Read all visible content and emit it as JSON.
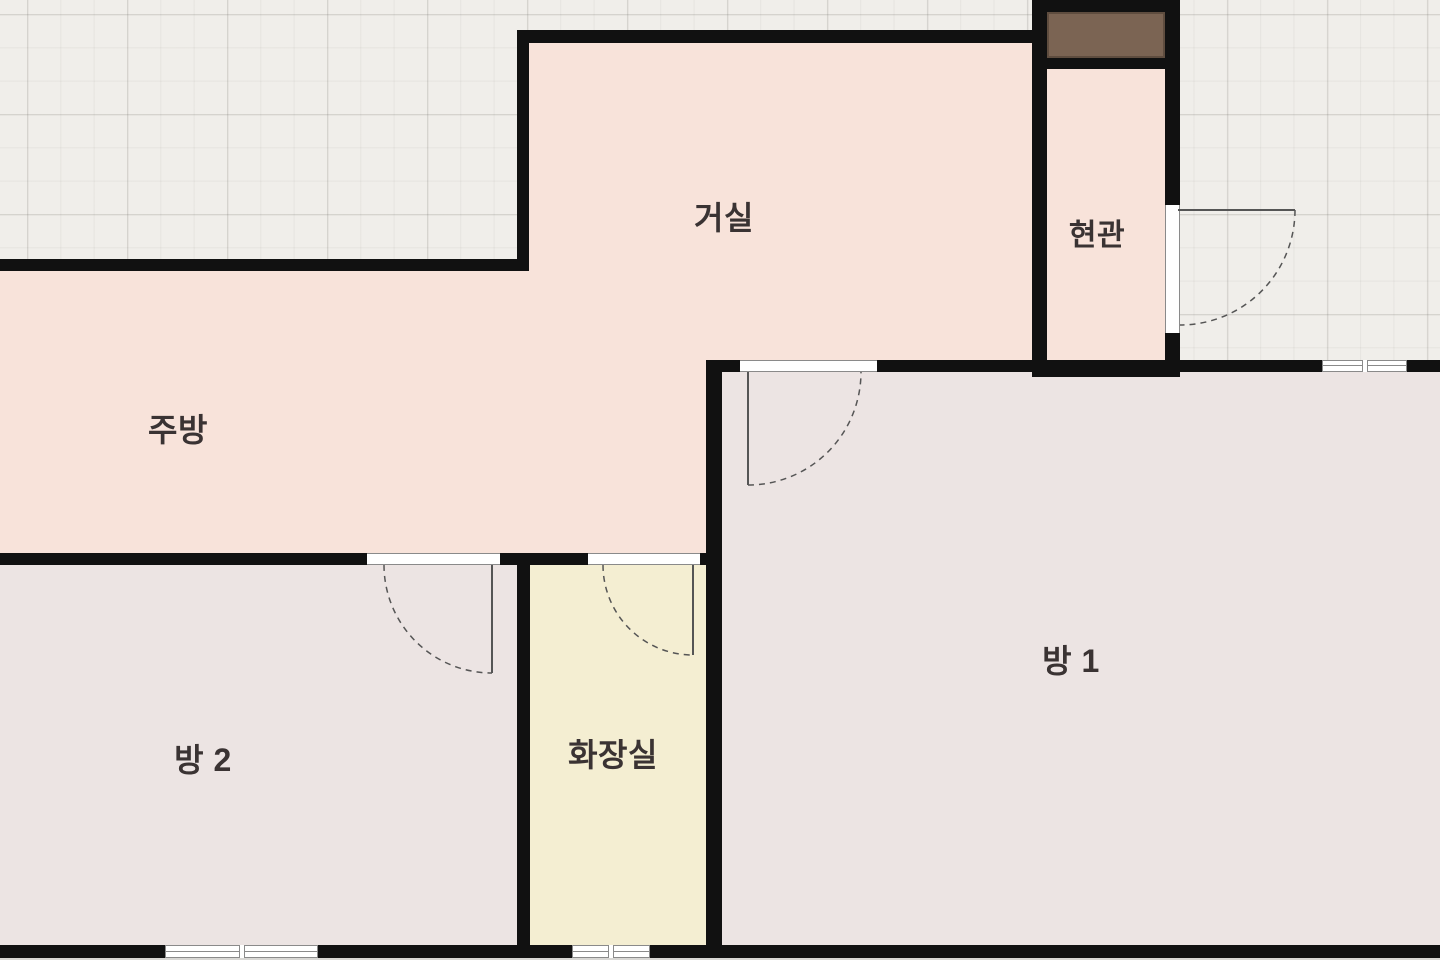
{
  "plan": {
    "rooms": [
      {
        "id": "living",
        "label": "거실"
      },
      {
        "id": "entrance",
        "label": "현관"
      },
      {
        "id": "kitchen",
        "label": "주방"
      },
      {
        "id": "room1",
        "label": "방 1"
      },
      {
        "id": "room2",
        "label": "방 2"
      },
      {
        "id": "bathroom",
        "label": "화장실"
      }
    ]
  },
  "colors": {
    "outside-bg": "#f0eeea",
    "room-warm": "#f8e3da",
    "room-neutral": "#ece4e3",
    "room-bath": "#f4eed2",
    "wall": "#111111",
    "frame-line": "#8a8a8a",
    "door-line": "#555555",
    "entrance-door": "#7b6453",
    "label-text": "#3a3333",
    "below-strip": "#d8d7d4"
  }
}
